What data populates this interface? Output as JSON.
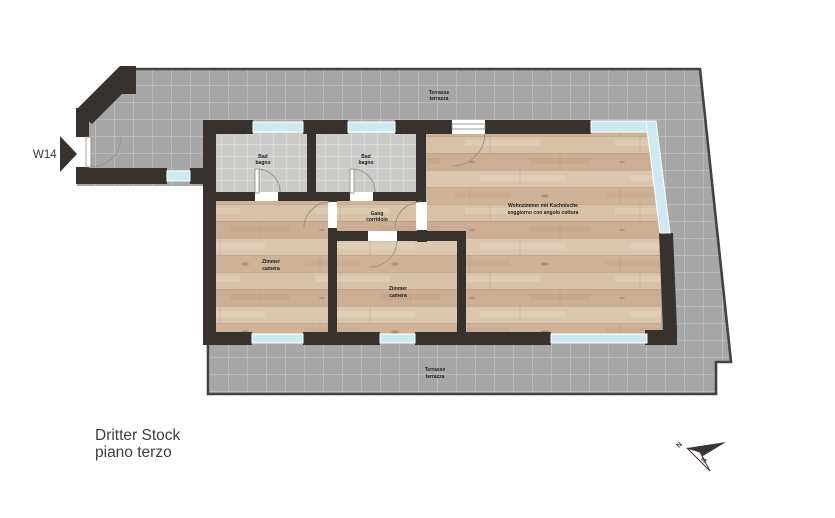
{
  "unit": {
    "label": "W14"
  },
  "floor_title": {
    "line1": "Dritter Stock",
    "line2": "piano terzo"
  },
  "rooms": {
    "terrace_top": {
      "line1": "Terrasse",
      "line2": "terrazza"
    },
    "terrace_bottom": {
      "line1": "Terrasse",
      "line2": "terrazza"
    },
    "bath_left": {
      "line1": "Bad",
      "line2": "bagno"
    },
    "bath_right": {
      "line1": "Bad",
      "line2": "bagno"
    },
    "hall": {
      "line1": "Gang",
      "line2": "corridoio"
    },
    "living": {
      "line1": "Wohnzimmer mit Kochnische",
      "line2": "soggiorno con angolo cottura"
    },
    "bedroom_left": {
      "line1": "Zimmer",
      "line2": "camera"
    },
    "bedroom_right": {
      "line1": "Zimmer",
      "line2": "camera"
    }
  },
  "compass": {
    "north": "N",
    "south": "S"
  },
  "colors": {
    "wall": "#38322e",
    "window": "#cfe9f1",
    "terrace_tile": "#a7a7a7",
    "terrace_grout": "#bcbcbc",
    "bath_tile": "#cbcbca",
    "wood_floor": "#d2b89f",
    "outline": "#46423e",
    "text": "#1d1d1d",
    "background": "#ffffff"
  }
}
